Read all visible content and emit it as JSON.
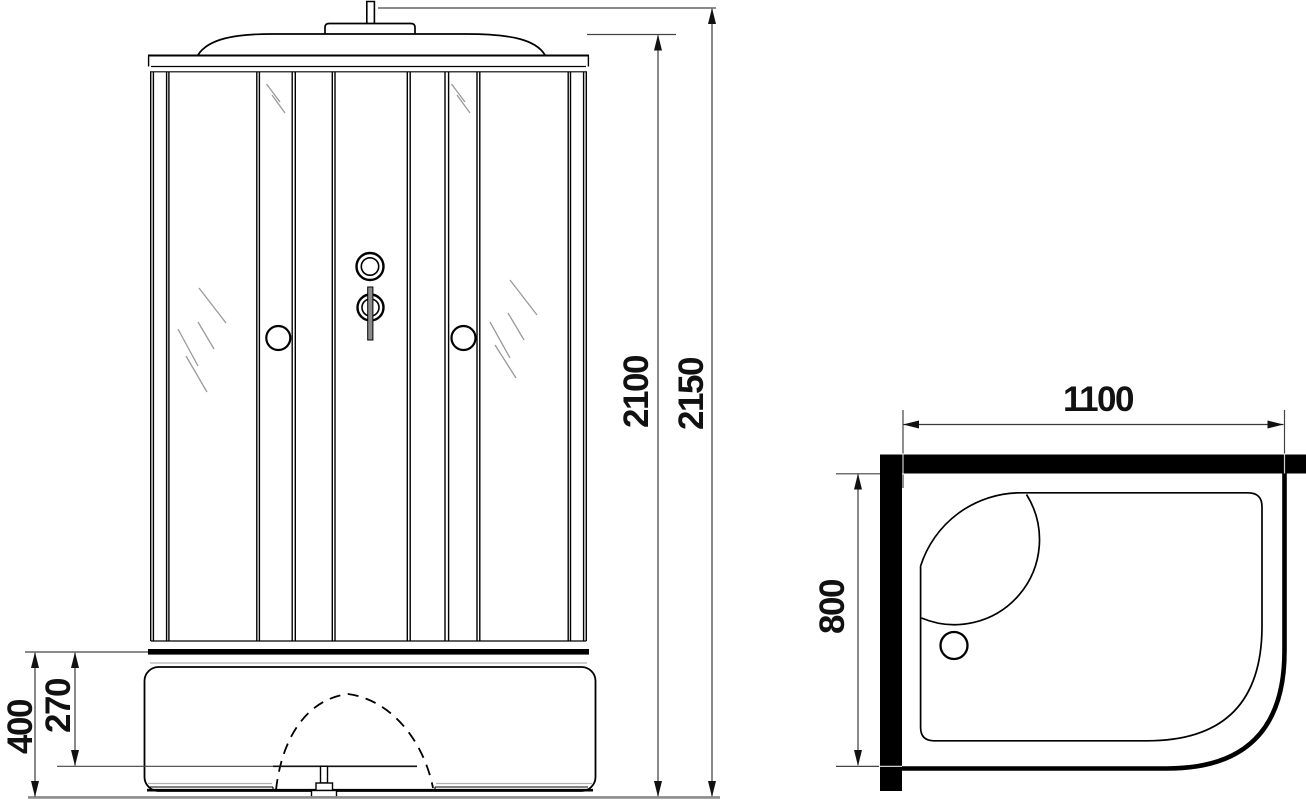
{
  "drawing": {
    "type": "shower-cabin-technical-drawing",
    "views": {
      "front": {
        "name": "front elevation",
        "dimensions": {
          "total_height": "2150",
          "cabin_height": "2100",
          "tray_height": "400",
          "tray_rim_height": "270"
        }
      },
      "plan": {
        "name": "top plan",
        "dimensions": {
          "width": "1100",
          "depth": "800"
        }
      }
    },
    "colors": {
      "line": "#000000",
      "dimension_line": "#3a3a3a",
      "arrow": "#111111",
      "glass_hatch": "#9a9a9a",
      "soft_gray": "#b0b0b0",
      "floor": "#8c8c8c",
      "wall_fill": "#000000"
    }
  }
}
